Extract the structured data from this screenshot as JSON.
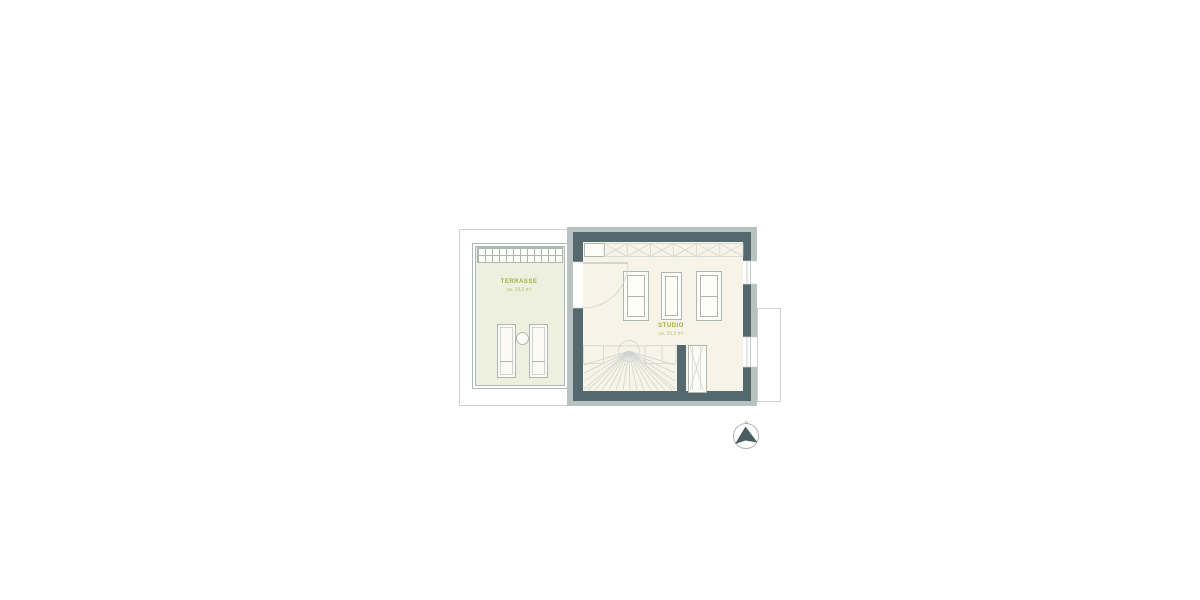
{
  "colors": {
    "wall": "#54696e",
    "wall_light": "#b8c2c1",
    "studio_floor": "#f7f3e6",
    "terrace_floor": "#edf0df",
    "accent_green": "#a3b23f",
    "accent_green_light": "#bcc76e",
    "line_gray": "#adb7b4",
    "outline_gray": "#ccd3d0",
    "arrow_dark": "#4a5e62"
  },
  "plan": {
    "rooms": [
      {
        "id": "terrasse",
        "label": "TERRASSE",
        "area": "ca. 18,5 m²"
      },
      {
        "id": "studio",
        "label": "STUDIO",
        "area": "ca. 26,5 m²"
      }
    ],
    "compass": {
      "north_label": "N"
    }
  },
  "icons": {
    "north_arrow": "north-arrow",
    "stair": "winder-stair",
    "door": "door-swing"
  }
}
